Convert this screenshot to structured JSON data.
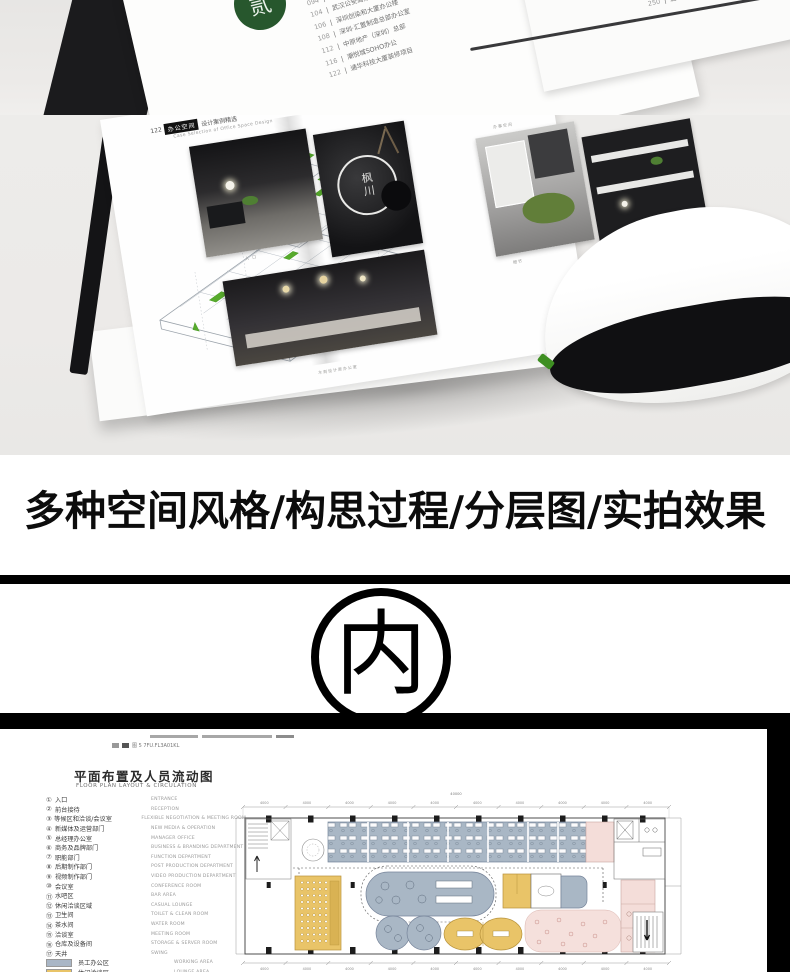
{
  "top_photo": {
    "seal_char": "贰",
    "sep": "|",
    "toc_left": [
      {
        "page": "092",
        "title": "金融街控股办公楼"
      },
      {
        "page": "094",
        "title": "西安联合办公空间"
      },
      {
        "page": "104",
        "title": "武汉公安局办公楼"
      },
      {
        "page": "106",
        "title": "深圳创染和大厦办公楼"
      },
      {
        "page": "108",
        "title": "深圳·汇置制造总部办公室"
      },
      {
        "page": "112",
        "title": "中原地产（深圳）总部"
      },
      {
        "page": "116",
        "title": "潮悦城SOHO办公"
      },
      {
        "page": "122",
        "title": "通华科技大厦装修项目"
      }
    ],
    "toc_right": [
      {
        "page": "246",
        "title": "季裕棠设计作品"
      },
      {
        "page": "248",
        "title": "致谢"
      },
      {
        "page": "250",
        "title": "后记"
      }
    ]
  },
  "spread": {
    "page_no": "122",
    "header_box": "办公空间",
    "header_rest": "设计案例精选",
    "header_en": "Case Selection of Office Space Design",
    "logo_text": "枫川",
    "captions": {
      "entry": "入 口",
      "office": "办事空间",
      "detail": "细节",
      "bottom": "木刻设计原办公室"
    }
  },
  "headline": {
    "text": "多种空间风格/构思过程/分层图/实拍效果"
  },
  "emblem": {
    "char": "内"
  },
  "floor_page": {
    "fragment": "图 5 7FU.FL3A01KL",
    "title": "平面布置及人员流动图",
    "subtitle": "FLOOR PLAN LAYOUT & CIRCULATION",
    "legend": [
      {
        "num": "①",
        "cn": "入口",
        "en": "ENTRANCE"
      },
      {
        "num": "②",
        "cn": "前台接待",
        "en": "RECEPTION"
      },
      {
        "num": "③",
        "cn": "等候区和洽谈/会议室",
        "en": "FLEXIBLE NEGOTIATION & MEETING ROOM"
      },
      {
        "num": "④",
        "cn": "新媒体及运营部门",
        "en": "NEW MEDIA & OPERATION"
      },
      {
        "num": "⑤",
        "cn": "总经理办公室",
        "en": "MANAGER OFFICE"
      },
      {
        "num": "⑥",
        "cn": "商务及品牌部门",
        "en": "BUSINESS & BRANDING DEPARTMENT"
      },
      {
        "num": "⑦",
        "cn": "职能部门",
        "en": "FUNCTION DEPARTMENT"
      },
      {
        "num": "⑧",
        "cn": "后期制作部门",
        "en": "POST PRODUCTION DEPARTMENT"
      },
      {
        "num": "⑨",
        "cn": "视频制作部门",
        "en": "VIDEO PRODUCTION DEPARTMENT"
      },
      {
        "num": "⑩",
        "cn": "会议室",
        "en": "CONFERENCE ROOM"
      },
      {
        "num": "⑪",
        "cn": "水吧区",
        "en": "BAR AREA"
      },
      {
        "num": "⑫",
        "cn": "休闲洽谈区域",
        "en": "CASUAL LOUNGE"
      },
      {
        "num": "⑬",
        "cn": "卫生间",
        "en": "TOILET & CLEAN ROOM"
      },
      {
        "num": "⑭",
        "cn": "茶水间",
        "en": "WATER ROOM"
      },
      {
        "num": "⑮",
        "cn": "洽谈室",
        "en": "MEETING ROOM"
      },
      {
        "num": "⑯",
        "cn": "仓库及设备间",
        "en": "STORAGE & SERVER ROOM"
      },
      {
        "num": "⑰",
        "cn": "天井",
        "en": "SWING"
      }
    ],
    "swatches": [
      {
        "color": "#a9b6c6",
        "cn": "员工办公区",
        "en": "WORKING AREA"
      },
      {
        "color": "#e9c468",
        "cn": "休闲洽谈区",
        "en": "LOUNGE AREA"
      }
    ],
    "dims": {
      "total": "40000",
      "top": [
        "4000",
        "4000",
        "4000",
        "4000",
        "4000",
        "4000",
        "4000",
        "4000",
        "4000",
        "4000"
      ],
      "bottom": [
        "4000",
        "4000",
        "4000",
        "4000",
        "4000",
        "4000",
        "4000",
        "4000",
        "4000",
        "4000"
      ]
    }
  },
  "colors": {
    "plan_blue": "#a9b7c5",
    "plan_yellow": "#e9c468",
    "plan_pink": "#f4ddd9",
    "accent_green": "#4a9e25",
    "bar_black": "#000000"
  }
}
